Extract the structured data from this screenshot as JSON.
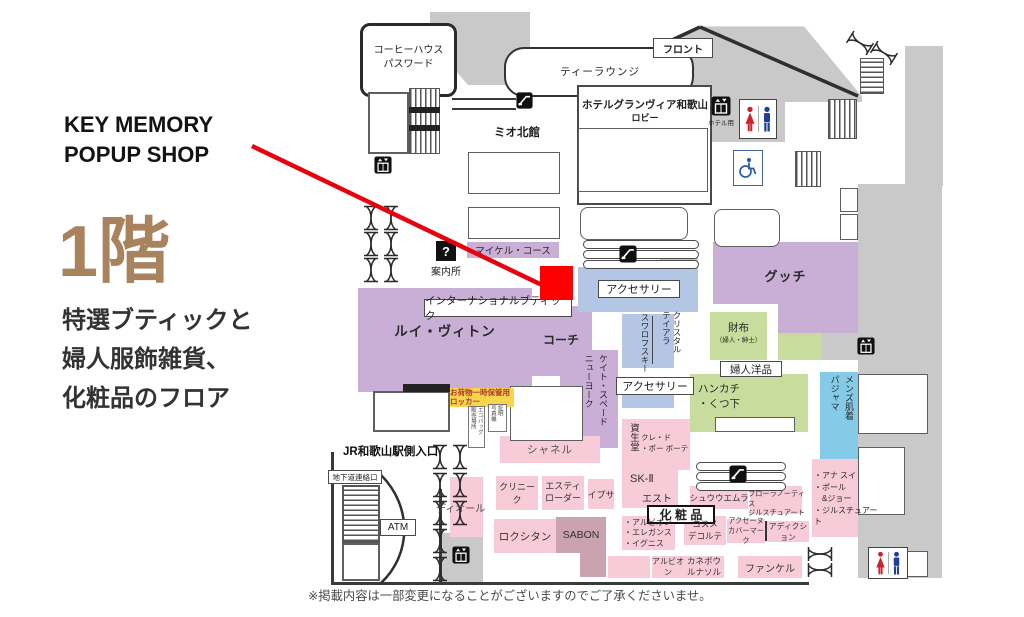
{
  "annotation": {
    "shop_title": "KEY MEMORY\nPOPUP SHOP",
    "floor_number": "1階",
    "floor_description": "特選ブティックと\n婦人服飾雑貨、\n化粧品のフロア",
    "accent_color": "#e8000d",
    "floor_number_color": "#a8835e"
  },
  "disclaimer": "※掲載内容は一部変更になることがございますのでご了承くださいませ。",
  "hotel": {
    "coffee_house": "コーヒーハウス\nパスワード",
    "tea_lounge": "ティーラウンジ",
    "front": "フロント",
    "lobby": "ホテルグランヴィア和歌山",
    "lobby_sub": "ロビー",
    "elevator_note": "ホテル用"
  },
  "station": {
    "mio_north": "ミオ北館",
    "jr_entrance": "JR和歌山駅側入口",
    "underground": "地下道連絡口",
    "atm": "ATM",
    "info_desk": "案内所",
    "info_glyph": "?"
  },
  "shops": {
    "michael_kors": "マイケル・コース",
    "international_boutique": "インターナショナルブティック",
    "louis_vuitton": "ルイ・ヴィトン",
    "coach": "コーチ",
    "kate_spade": "ケイト・スペード\nニューヨーク",
    "chanel": "シャネル",
    "gucci": "グッチ",
    "accessory_upper": "アクセサリー",
    "accessory_lower": "アクセサリー",
    "crystal_tiara": "クリスタル\nテイアラ",
    "swarovski": "スワロフスキー",
    "wallet": "財布",
    "wallet_sub": "（婦人・紳士）",
    "womens_goods": "婦人洋品",
    "handkerchief_socks": "ハンカチ\n・くつ下",
    "mens_underwear": "メンズ肌着\nパジャマ",
    "anna_sui_group": "・アナ スイ\n・ポール\n　&ジョー\n・ジルスチュアート",
    "shiseido": "資生堂",
    "cle_de_peau": "クレ・ド\n・ポー ボーテ",
    "dior": "ディオール",
    "clinique": "クリニーク",
    "estee_lauder": "エスティ\nローダー",
    "ipsa": "イプサ",
    "sk2": "SK-Ⅱ",
    "est": "エスト",
    "cosmetics_label": "化 粧 品",
    "shu_uemura": "シュウウエムラ",
    "flowernotis": "フローラノーティス\nジルスチュアート",
    "albion_group": "・アルビオン\n・エレガンス\n・イグニス",
    "cosme_decorte": "コスメ\nデコルテ",
    "acseine": "アクセーヌ\nカバーマーク",
    "addiction": "アディクション",
    "loccitane": "ロクシタン",
    "sabon": "SABON",
    "albion": "アルビオン",
    "kanebo_lunasol": "カネボウ\nルナソル",
    "fancl": "ファンケル",
    "locker_note": "お荷物一時保管用\nロッカー",
    "eco_bag": "エコバッグ\n販売場所",
    "photo_booth": "証明\n写真機"
  },
  "legend_colors": {
    "boutique": "#c9aed6",
    "goods": "#c8dc9e",
    "accessory": "#b3c6e4",
    "mens": "#85cbe8",
    "cosmetics": "#f8cbd9",
    "cosmetics_dark": "#cba3b0",
    "building": "#c9c9c9"
  }
}
